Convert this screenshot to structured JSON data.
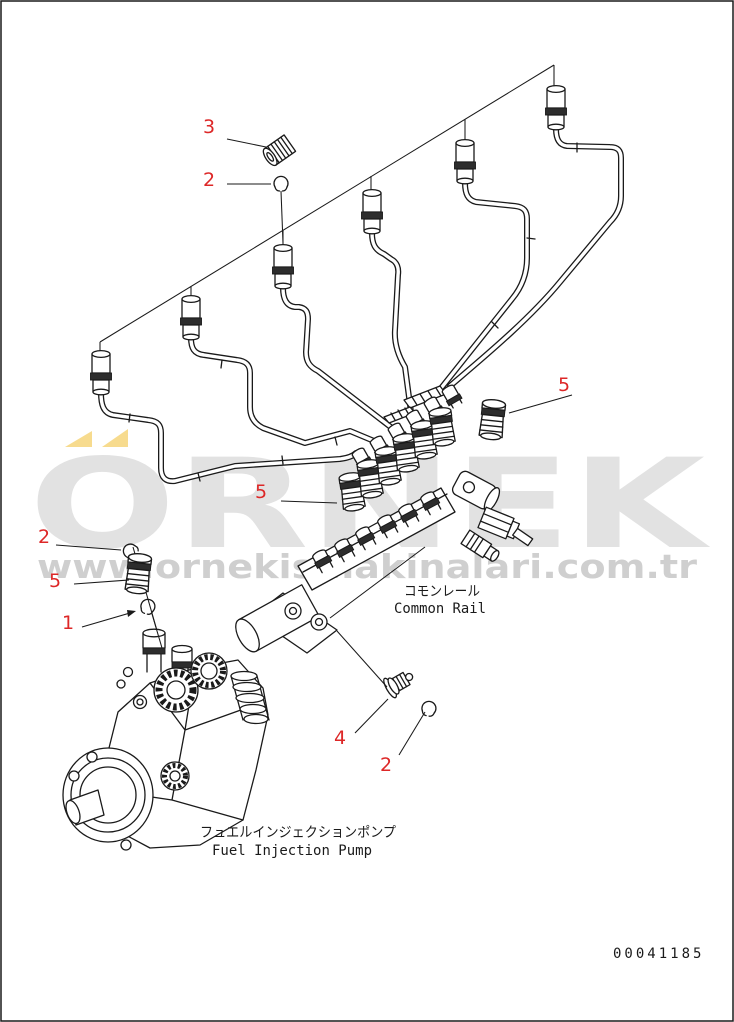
{
  "watermark": {
    "brand": "ÖRNEK",
    "brand_letters": "ORNEK",
    "url": "www.ornekismakinalari.com.tr",
    "brand_color": "#e2e2e2",
    "url_color": "#cfcfcf",
    "accent_color": "#f7db8e"
  },
  "diagram": {
    "callout_color": "#dd2727",
    "line_color": "#1a1a1a",
    "callouts": [
      {
        "ref": "3"
      },
      {
        "ref": "2"
      },
      {
        "ref": "5"
      },
      {
        "ref": "5"
      },
      {
        "ref": "2"
      },
      {
        "ref": "5"
      },
      {
        "ref": "1"
      },
      {
        "ref": "4"
      },
      {
        "ref": "2"
      }
    ],
    "labels": {
      "common_rail_jp": "コモンレール",
      "common_rail_en": "Common Rail",
      "fuel_injection_pump_jp": "フュエルインジェクションポンプ",
      "fuel_injection_pump_en": "Fuel Injection Pump"
    },
    "figure_number": "00041185"
  }
}
